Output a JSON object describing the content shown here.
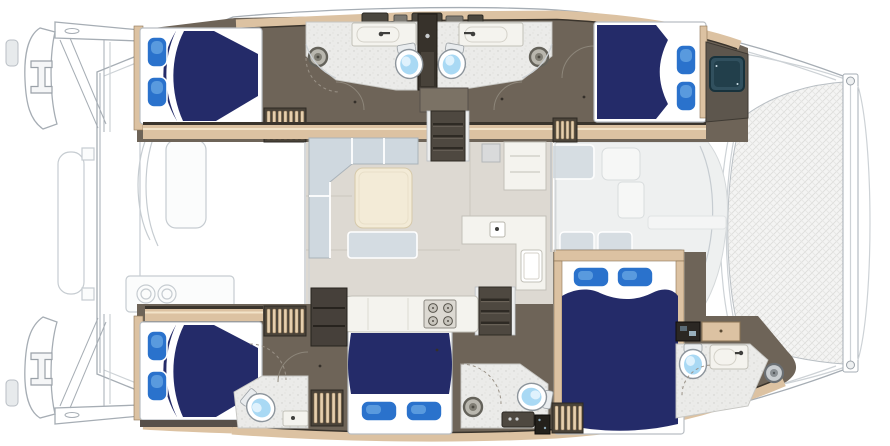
{
  "figure": {
    "type": "floor-plan",
    "subject": "sailing catamaran interior deck plan, top-down view",
    "orientation": "bow-right-stern-left"
  },
  "colors": {
    "background": "#ffffff",
    "deck_white": "#ffffff",
    "hull_outline": "#a6adb4",
    "hull_line_light": "#cdd2d6",
    "ghost_fill": "#fbfcfc",
    "ghost_stroke": "#c6ccd1",
    "walkway_floor": "#6e6458",
    "walkway_shadow": "#57504a",
    "cabinet_dark": "#46403a",
    "corridor_dark": "#37322b",
    "wood_trim": "#dcc2a2",
    "wood_edge": "#3a342c",
    "wood_slat": "#e6cfae",
    "wood_slat_edge": "#8a7354",
    "mattress": "#ffffff",
    "duvet_navy": "#242b69",
    "pillow_blue": "#2a72cc",
    "pillow_highlight": "#6aa8e4",
    "bath_floor": "#ebebe9",
    "bath_speckle": "#cfcfcb",
    "saloon_floor": "#ddd9d2",
    "saloon_seam": "#cbc7bf",
    "settee": "#cfd8df",
    "table_cream": "#f3ebd7",
    "table_edge": "#d6c9aa",
    "counter": "#f4f3ee",
    "counter_edge": "#c2c0b8",
    "stove_body": "#dcd9d2",
    "stove_edge": "#8e8b84",
    "burner": "#55524a",
    "toilet_white": "#ffffff",
    "toilet_edge": "#8d959c",
    "toilet_bowl": "#a9d9f4",
    "drain_ring": "#64625a",
    "drain_fill": "#b9b7ae",
    "hatch_teal": "#31505e",
    "hatch_teal_dark": "#223f4b",
    "hatch_gray": "#7d7a73",
    "hatch_gray_dark": "#4a463e",
    "tramp_base": "#f4f4f3",
    "tramp_mesh": "#dcdcda",
    "fwd_floor": "#eef0f0",
    "fwd_seat": "#d6dde2",
    "steel": "#c9cdd0"
  },
  "inventory": {
    "cabins": [
      {
        "name": "port-aft-cabin",
        "bed": "island-double",
        "pillows": 2
      },
      {
        "name": "port-forward-cabin",
        "bed": "island-double",
        "pillows": 2
      },
      {
        "name": "starboard-aft-cabin",
        "bed": "island-double",
        "pillows": 2
      },
      {
        "name": "starboard-mid-cabin",
        "bed": "double",
        "pillows": 2
      },
      {
        "name": "starboard-forward-cabin",
        "bed": "island-double",
        "pillows": 2
      }
    ],
    "heads": [
      {
        "name": "port-aft-head",
        "fixtures": [
          "toilet",
          "sink",
          "shower-drain"
        ]
      },
      {
        "name": "port-forward-head",
        "fixtures": [
          "toilet",
          "sink",
          "shower-drain"
        ]
      },
      {
        "name": "starboard-aft-head",
        "fixtures": [
          "toilet",
          "vanity"
        ]
      },
      {
        "name": "starboard-mid-head",
        "fixtures": [
          "toilet",
          "vanity",
          "shower-drain"
        ]
      },
      {
        "name": "starboard-forward-head",
        "fixtures": [
          "toilet",
          "sink",
          "shower-drain"
        ]
      }
    ],
    "saloon": [
      "l-shaped-settee",
      "coffee-table",
      "chaise-seat",
      "refrigerator",
      "nav-counter-with-sink",
      "galley-counter",
      "four-burner-stove",
      "storage-cabinet"
    ],
    "companionways": [
      "port-companionway-stairs",
      "starboard-companionway-stairs"
    ],
    "exterior": [
      "aft-cockpit-table",
      "aft-cockpit-seating",
      "wet-bar-twin-sinks",
      "davit-rail",
      "transom-steps",
      "mooring-cleats",
      "forward-cockpit-seating",
      "bow-trampoline",
      "forward-crossbeam",
      "anchor-bridle",
      "windlass",
      "deck-hatches",
      "bow-locker-hatch"
    ]
  }
}
